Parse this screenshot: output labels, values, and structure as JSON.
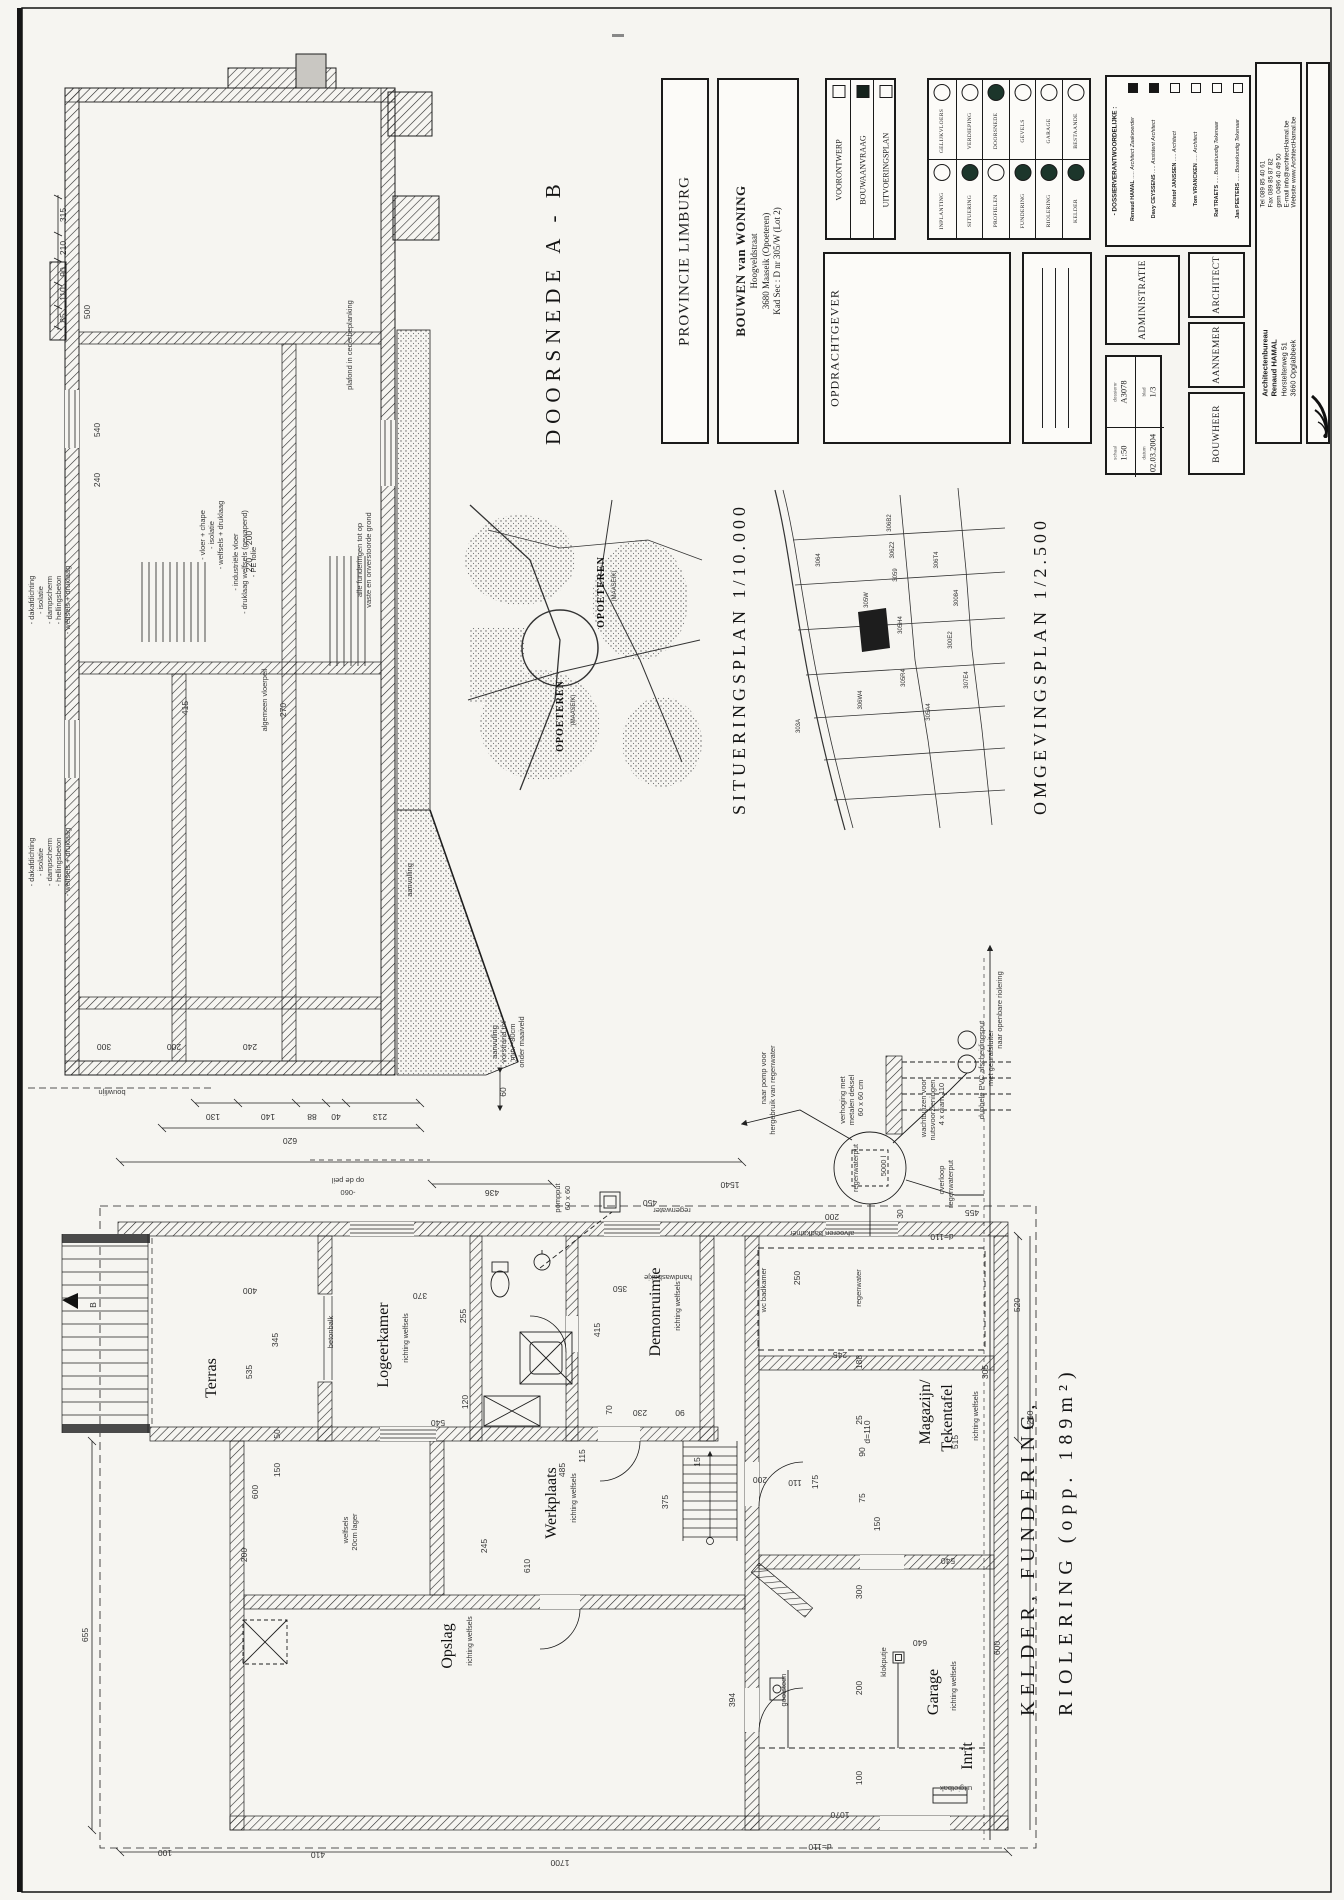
{
  "page": {
    "bg": "#f6f5f1",
    "ink": "#1c1c1c"
  },
  "titles": {
    "doorsnede": "DOORSNEDE A - B",
    "situering": "SITUERINGSPLAN 1/10.000",
    "omgeving": "OMGEVINGSPLAN 1/2.500",
    "kelder1": "KELDER, FUNDERING,",
    "kelder2": "RIOLERING (opp. 189m²)"
  },
  "titleblock": {
    "province": "PROVINCIE LIMBURG",
    "project": {
      "title": "BOUWEN van WONING",
      "street": "Hoogveldstraat",
      "city": "3680 Maaseik (Opoeteren)",
      "kad": "Kad Sec : D nr 305/W (Lot 2)"
    },
    "phases": [
      {
        "label": "VOORONTWERP",
        "checked": false
      },
      {
        "label": "BOUWAANVRAAG",
        "checked": true
      },
      {
        "label": "UITVOERINGSPLAN",
        "checked": false
      }
    ],
    "sheets_top": [
      {
        "label": "GELIJKVLOERS",
        "filled": false
      },
      {
        "label": "VERDIEPING",
        "filled": false
      },
      {
        "label": "DOORSNEDE",
        "filled": true
      },
      {
        "label": "GEVELS",
        "filled": false
      },
      {
        "label": "GARAGE",
        "filled": false
      },
      {
        "label": "BESTAANDE",
        "filled": false
      }
    ],
    "sheets_bottom": [
      {
        "label": "INPLANTING",
        "filled": false
      },
      {
        "label": "SITUERING",
        "filled": true
      },
      {
        "label": "PROFIELEN",
        "filled": false
      },
      {
        "label": "FUNDERING",
        "filled": true
      },
      {
        "label": "RIOLERING",
        "filled": true
      },
      {
        "label": "KELDER",
        "filled": true
      }
    ],
    "client_label": "OPDRACHTGEVER",
    "dossier_header": "- DOSSIERVERANTWOORDELIJKE :",
    "dossier_people": [
      {
        "name": "Renaud HAMAL",
        "role": "Architect Zaakvoerder",
        "checked": true
      },
      {
        "name": "Davy CEYSSENS",
        "role": "Assistent Architect",
        "checked": true
      },
      {
        "name": "Kristof JANSSEN",
        "role": "Architect",
        "checked": false
      },
      {
        "name": "Tom VRANCKEN",
        "role": "Architect",
        "checked": false
      },
      {
        "name": "Raf TRAETS",
        "role": "Bouwkundig Tekenaar",
        "checked": false
      },
      {
        "name": "Jan PEETERS",
        "role": "Bouwkundig Tekenaar",
        "checked": false
      }
    ],
    "administratie_label": "ADMINISTRATIE",
    "architect_label": "ARCHITECT",
    "aannemer_label": "AANNEMER",
    "bouwheer_label": "BOUWHEER",
    "meta": {
      "dossier_label": "dossiernr",
      "dossier": "A3078",
      "blad_label": "blad",
      "blad": "1/3",
      "schaal_label": "schaal",
      "schaal": "1:50",
      "datum_label": "datum",
      "datum": "02.03.2004"
    },
    "firm": {
      "name1": "Architectenbureau",
      "name2": "Renaud HAMAL",
      "addr1": "Horstelterweg 51",
      "addr2": "3660 Opglabbeek",
      "tel": "Tel      089 85 40 61",
      "fax": "Fax     089 85 87 82",
      "gsm": "gsm    0496 40 49 50",
      "email": "E-mail  info@architectHamal.be",
      "web": "Website  www.ArchitectHamal.be"
    }
  },
  "section": {
    "labels": [
      {
        "t": "- dakafdichting",
        "x": 34,
        "y": 600,
        "c": "note"
      },
      {
        "t": "- isolatie",
        "x": 43,
        "y": 600,
        "c": "note"
      },
      {
        "t": "- dampscherm",
        "x": 52,
        "y": 600,
        "c": "note"
      },
      {
        "t": "- hellingsbeton",
        "x": 61,
        "y": 600,
        "c": "note"
      },
      {
        "t": "- welfsels + druklaag",
        "x": 70,
        "y": 600,
        "c": "note"
      },
      {
        "t": "- dakafdichting",
        "x": 34,
        "y": 862,
        "c": "note"
      },
      {
        "t": "- isolatie",
        "x": 43,
        "y": 862,
        "c": "note"
      },
      {
        "t": "- dampscherm",
        "x": 52,
        "y": 862,
        "c": "note"
      },
      {
        "t": "- hellingsbeton",
        "x": 61,
        "y": 862,
        "c": "note"
      },
      {
        "t": "- welfsels + druklaag",
        "x": 70,
        "y": 862,
        "c": "note"
      },
      {
        "t": "- vloer + chape",
        "x": 205,
        "y": 535,
        "c": "note"
      },
      {
        "t": "- isolatie",
        "x": 214,
        "y": 535,
        "c": "note"
      },
      {
        "t": "- welfsels + druklaag",
        "x": 223,
        "y": 535,
        "c": "note"
      },
      {
        "t": "- industriële vloer",
        "x": 238,
        "y": 562,
        "c": "note"
      },
      {
        "t": "- druklaag welfsels (gewapend)",
        "x": 247,
        "y": 562,
        "c": "note"
      },
      {
        "t": "- PE folie",
        "x": 256,
        "y": 562,
        "c": "note"
      },
      {
        "t": "plafond in cederbeplanking",
        "x": 352,
        "y": 345,
        "c": "note"
      },
      {
        "t": "alle funderingen tot op",
        "x": 362,
        "y": 560,
        "c": "note"
      },
      {
        "t": "vaste en onverstoorde grond",
        "x": 371,
        "y": 560,
        "c": "note"
      },
      {
        "t": "algemeen vloerpeil",
        "x": 267,
        "y": 700,
        "c": "note"
      },
      {
        "t": "aanvulling",
        "x": 412,
        "y": 880,
        "c": "note"
      },
      {
        "t": "aanvulling",
        "x": 497,
        "y": 1042,
        "c": "note"
      },
      {
        "t": "vorstrand tot",
        "x": 506,
        "y": 1042,
        "c": "note"
      },
      {
        "t": "min. -80cm",
        "x": 515,
        "y": 1042,
        "c": "note"
      },
      {
        "t": "onder maaiveld",
        "x": 524,
        "y": 1042,
        "c": "note"
      },
      {
        "t": "bouwlijn",
        "x": 112,
        "y": 1090,
        "r": 180,
        "c": "note"
      },
      {
        "t": "op de peil",
        "x": 348,
        "y": 1178,
        "r": 180,
        "c": "note"
      },
      {
        "t": "-060",
        "x": 348,
        "y": 1190,
        "r": 180,
        "c": "note"
      },
      {
        "t": "315",
        "x": 66,
        "y": 215
      },
      {
        "t": "210",
        "x": 66,
        "y": 248
      },
      {
        "t": "90",
        "x": 66,
        "y": 272
      },
      {
        "t": "110",
        "x": 66,
        "y": 294
      },
      {
        "t": "85",
        "x": 66,
        "y": 318
      },
      {
        "t": "500",
        "x": 90,
        "y": 312
      },
      {
        "t": "540",
        "x": 100,
        "y": 430
      },
      {
        "t": "240",
        "x": 100,
        "y": 480
      },
      {
        "t": "200",
        "x": 252,
        "y": 538
      },
      {
        "t": "220",
        "x": 252,
        "y": 565
      },
      {
        "t": "415",
        "x": 188,
        "y": 708
      },
      {
        "t": "270",
        "x": 286,
        "y": 710
      },
      {
        "t": "300",
        "x": 104,
        "y": 1044,
        "r": 180
      },
      {
        "t": "200",
        "x": 174,
        "y": 1044,
        "r": 180
      },
      {
        "t": "240",
        "x": 250,
        "y": 1044,
        "r": 180
      },
      {
        "t": "130",
        "x": 213,
        "y": 1114,
        "r": 180
      },
      {
        "t": "140",
        "x": 268,
        "y": 1114,
        "r": 180
      },
      {
        "t": "88",
        "x": 312,
        "y": 1114,
        "r": 180
      },
      {
        "t": "40",
        "x": 336,
        "y": 1114,
        "r": 180
      },
      {
        "t": "213",
        "x": 380,
        "y": 1114,
        "r": 180
      },
      {
        "t": "620",
        "x": 290,
        "y": 1138,
        "r": 180
      },
      {
        "t": "60",
        "x": 506,
        "y": 1092
      },
      {
        "t": "436",
        "x": 492,
        "y": 1190,
        "r": 180
      },
      {
        "t": "B",
        "x": 96,
        "y": 1305,
        "s": 10
      }
    ]
  },
  "plan": {
    "rooms": [
      {
        "t": "Terras",
        "x": 216,
        "y": 1378
      },
      {
        "t": "Logeerkamer",
        "x": 388,
        "y": 1345
      },
      {
        "t": "Demonruimte",
        "x": 660,
        "y": 1312
      },
      {
        "t": "Werkplaats",
        "x": 556,
        "y": 1503
      },
      {
        "t": "Opslag",
        "x": 452,
        "y": 1646
      },
      {
        "t": "Magazijn/",
        "x": 930,
        "y": 1412
      },
      {
        "t": "Tekentafel",
        "x": 952,
        "y": 1418
      },
      {
        "t": "Garage",
        "x": 938,
        "y": 1692
      },
      {
        "t": "Inrit",
        "x": 972,
        "y": 1756
      }
    ],
    "labels": [
      {
        "t": "richting welfsels",
        "x": 408,
        "y": 1338,
        "c": "sub"
      },
      {
        "t": "richting welfsels",
        "x": 680,
        "y": 1306,
        "c": "sub"
      },
      {
        "t": "richting welfsels",
        "x": 576,
        "y": 1498,
        "c": "sub"
      },
      {
        "t": "richting welfsels",
        "x": 472,
        "y": 1641,
        "c": "sub"
      },
      {
        "t": "richting welfsels",
        "x": 978,
        "y": 1416,
        "c": "sub"
      },
      {
        "t": "richting welfsels",
        "x": 956,
        "y": 1686,
        "c": "sub"
      },
      {
        "t": "pompput",
        "x": 560,
        "y": 1198,
        "c": "note"
      },
      {
        "t": "60 x 60",
        "x": 570,
        "y": 1198,
        "c": "note"
      },
      {
        "t": "regenwaterput",
        "x": 858,
        "y": 1168,
        "c": "note",
        "s": 6.2
      },
      {
        "t": "5000 l",
        "x": 886,
        "y": 1166,
        "c": "note"
      },
      {
        "t": "verhoging met",
        "x": 845,
        "y": 1100,
        "c": "note"
      },
      {
        "t": "metalen deksel",
        "x": 854,
        "y": 1100,
        "c": "note"
      },
      {
        "t": "60 x 60 cm",
        "x": 863,
        "y": 1098,
        "c": "note"
      },
      {
        "t": "naar pomp voor",
        "x": 766,
        "y": 1078,
        "c": "note"
      },
      {
        "t": "hergebruik van regenwater",
        "x": 775,
        "y": 1090,
        "c": "note"
      },
      {
        "t": "overloop",
        "x": 944,
        "y": 1180,
        "c": "note"
      },
      {
        "t": "regenwaterput",
        "x": 953,
        "y": 1184,
        "c": "note"
      },
      {
        "t": "afvoeren badkamer",
        "x": 822,
        "y": 1231,
        "r": 180,
        "c": "note"
      },
      {
        "t": "handwasbakje",
        "x": 668,
        "y": 1275,
        "r": 180,
        "c": "note"
      },
      {
        "t": "regenwater",
        "x": 672,
        "y": 1208,
        "r": 180,
        "c": "note"
      },
      {
        "t": "regenwater",
        "x": 861,
        "y": 1288,
        "c": "note"
      },
      {
        "t": "wc badkamer",
        "x": 766,
        "y": 1290,
        "c": "note"
      },
      {
        "t": "betonbalk",
        "x": 333,
        "y": 1332,
        "c": "note"
      },
      {
        "t": "welfsels",
        "x": 348,
        "y": 1530,
        "c": "note"
      },
      {
        "t": "20cm lager",
        "x": 357,
        "y": 1532,
        "c": "note"
      },
      {
        "t": "gootsteen",
        "x": 786,
        "y": 1690,
        "c": "note"
      },
      {
        "t": "klokputje",
        "x": 886,
        "y": 1662,
        "c": "note"
      },
      {
        "t": "uitgietbak",
        "x": 956,
        "y": 1786,
        "r": 180,
        "c": "note"
      },
      {
        "t": "dubbele PVC afscheidingsput",
        "x": 984,
        "y": 1070,
        "c": "note"
      },
      {
        "t": "met geurafsluiter",
        "x": 993,
        "y": 1058,
        "c": "note"
      },
      {
        "t": "wachtbuizen voor",
        "x": 926,
        "y": 1108,
        "c": "note"
      },
      {
        "t": "nutsvoorzieningen",
        "x": 935,
        "y": 1110,
        "c": "note"
      },
      {
        "t": "4 x diam 110",
        "x": 944,
        "y": 1104,
        "c": "note"
      },
      {
        "t": "naar openbare riolering",
        "x": 1002,
        "y": 1010,
        "c": "note"
      },
      {
        "t": "1540",
        "x": 730,
        "y": 1182,
        "r": 180
      },
      {
        "t": "450",
        "x": 650,
        "y": 1200,
        "r": 180
      },
      {
        "t": "455",
        "x": 972,
        "y": 1210,
        "r": 180
      },
      {
        "t": "200",
        "x": 832,
        "y": 1214,
        "r": 180
      },
      {
        "t": "30",
        "x": 903,
        "y": 1214
      },
      {
        "t": "250",
        "x": 800,
        "y": 1278
      },
      {
        "t": "400",
        "x": 250,
        "y": 1288,
        "r": 180
      },
      {
        "t": "370",
        "x": 420,
        "y": 1293,
        "r": 180
      },
      {
        "t": "345",
        "x": 278,
        "y": 1340
      },
      {
        "t": "535",
        "x": 252,
        "y": 1372
      },
      {
        "t": "255",
        "x": 466,
        "y": 1316
      },
      {
        "t": "540",
        "x": 438,
        "y": 1420,
        "r": 180
      },
      {
        "t": "120",
        "x": 468,
        "y": 1402
      },
      {
        "t": "415",
        "x": 600,
        "y": 1330
      },
      {
        "t": "350",
        "x": 620,
        "y": 1286,
        "r": 180
      },
      {
        "t": "230",
        "x": 640,
        "y": 1410,
        "r": 180
      },
      {
        "t": "90",
        "x": 680,
        "y": 1410,
        "r": 180
      },
      {
        "t": "70",
        "x": 612,
        "y": 1410
      },
      {
        "t": "50",
        "x": 280,
        "y": 1434
      },
      {
        "t": "150",
        "x": 280,
        "y": 1470
      },
      {
        "t": "600",
        "x": 258,
        "y": 1492
      },
      {
        "t": "200",
        "x": 247,
        "y": 1555
      },
      {
        "t": "655",
        "x": 88,
        "y": 1635
      },
      {
        "t": "245",
        "x": 487,
        "y": 1546
      },
      {
        "t": "610",
        "x": 530,
        "y": 1566
      },
      {
        "t": "485",
        "x": 565,
        "y": 1470
      },
      {
        "t": "115",
        "x": 585,
        "y": 1456
      },
      {
        "t": "15",
        "x": 700,
        "y": 1462
      },
      {
        "t": "375",
        "x": 668,
        "y": 1502
      },
      {
        "t": "305",
        "x": 988,
        "y": 1372
      },
      {
        "t": "515",
        "x": 958,
        "y": 1442
      },
      {
        "t": "188",
        "x": 862,
        "y": 1362
      },
      {
        "t": "245",
        "x": 840,
        "y": 1352,
        "r": 180
      },
      {
        "t": "25",
        "x": 862,
        "y": 1420
      },
      {
        "t": "90",
        "x": 865,
        "y": 1452
      },
      {
        "t": "75",
        "x": 865,
        "y": 1498
      },
      {
        "t": "150",
        "x": 880,
        "y": 1524
      },
      {
        "t": "175",
        "x": 818,
        "y": 1482
      },
      {
        "t": "110",
        "x": 795,
        "y": 1480,
        "r": 180
      },
      {
        "t": "200",
        "x": 760,
        "y": 1477,
        "r": 180
      },
      {
        "t": "300",
        "x": 862,
        "y": 1592
      },
      {
        "t": "200",
        "x": 862,
        "y": 1688
      },
      {
        "t": "100",
        "x": 862,
        "y": 1778
      },
      {
        "t": "640",
        "x": 920,
        "y": 1640,
        "r": 180
      },
      {
        "t": "600",
        "x": 1000,
        "y": 1648
      },
      {
        "t": "394",
        "x": 735,
        "y": 1700
      },
      {
        "t": "540",
        "x": 948,
        "y": 1558,
        "r": 180
      },
      {
        "t": "1070",
        "x": 840,
        "y": 1812,
        "r": 180
      },
      {
        "t": "1700",
        "x": 560,
        "y": 1860,
        "r": 180
      },
      {
        "t": "410",
        "x": 318,
        "y": 1852,
        "r": 180
      },
      {
        "t": "100",
        "x": 165,
        "y": 1850,
        "r": 180
      },
      {
        "t": "d=110",
        "x": 820,
        "y": 1844,
        "r": 180
      },
      {
        "t": "d=110",
        "x": 870,
        "y": 1432
      },
      {
        "t": "d=110",
        "x": 942,
        "y": 1234,
        "r": 180
      },
      {
        "t": "520",
        "x": 1020,
        "y": 1305
      },
      {
        "t": "1250",
        "x": 1033,
        "y": 1420
      }
    ]
  },
  "maps": {
    "situering": {
      "labels": [
        {
          "t": "OPOETEREN",
          "x": 604,
          "y": 592,
          "c": "mapbold"
        },
        {
          "t": "(MAASEIK)",
          "x": 616,
          "y": 586,
          "c": "map"
        },
        {
          "t": "OPOETEREN",
          "x": 563,
          "y": 716,
          "c": "mapbold"
        },
        {
          "t": "(MAASEIK)",
          "x": 575,
          "y": 710,
          "c": "map"
        }
      ]
    },
    "omgeving": {
      "labels": [
        {
          "t": "306B2",
          "x": 891,
          "y": 523
        },
        {
          "t": "306Z2",
          "x": 894,
          "y": 550
        },
        {
          "t": "3059",
          "x": 897,
          "y": 575
        },
        {
          "t": "305W",
          "x": 868,
          "y": 600
        },
        {
          "t": "305H4",
          "x": 902,
          "y": 625
        },
        {
          "t": "305R4",
          "x": 905,
          "y": 678
        },
        {
          "t": "306T4",
          "x": 938,
          "y": 560
        },
        {
          "t": "300E2",
          "x": 952,
          "y": 640
        },
        {
          "t": "305A4",
          "x": 930,
          "y": 712
        },
        {
          "t": "303A",
          "x": 800,
          "y": 726
        },
        {
          "t": "30084",
          "x": 958,
          "y": 598
        },
        {
          "t": "306W4",
          "x": 862,
          "y": 700
        },
        {
          "t": "307E4",
          "x": 968,
          "y": 680
        },
        {
          "t": "3064",
          "x": 820,
          "y": 560
        }
      ]
    }
  }
}
